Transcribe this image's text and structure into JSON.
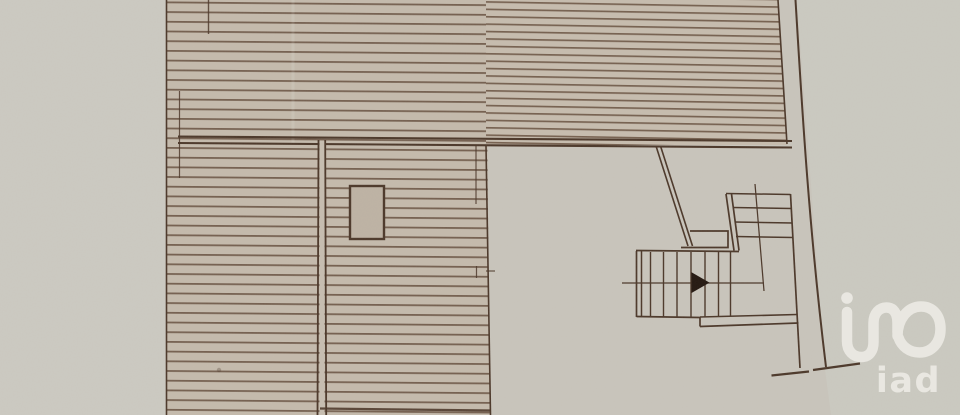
{
  "document": {
    "kind": "scanned architectural floor plan",
    "visible_text": [
      "iad"
    ]
  },
  "watermark": {
    "brand_text": "iad",
    "mark_icon": "iad-monogram-icon"
  },
  "plan": {
    "regions": [
      {
        "name": "upper-hatched-band",
        "kind": "hatched roof/terrace band across the top"
      },
      {
        "name": "left-hatched-block",
        "kind": "hatched roof/terrace column on the left"
      },
      {
        "name": "open-floor-area",
        "kind": "unhatched room floor, center right"
      },
      {
        "name": "staircase",
        "kind": "two-flight stair with direction line and arrow"
      },
      {
        "name": "column-rect",
        "kind": "small rectangular column/chimney in hatched area"
      },
      {
        "name": "right-wall",
        "kind": "long slanted wall line on the right with end cap"
      }
    ]
  },
  "colors": {
    "paper": "#c9c5bc",
    "paper_margin": "#cccac2",
    "hatch_bg": "#c5bbad",
    "hatch_bg_right": "#c7bdaf",
    "hatch_line": "#6d5746",
    "ink": "#4c382a",
    "arrow": "#241811",
    "column_fill": "#beb3a4",
    "wall_gap": "#c7beb1",
    "watermark": "#f0eee9"
  }
}
